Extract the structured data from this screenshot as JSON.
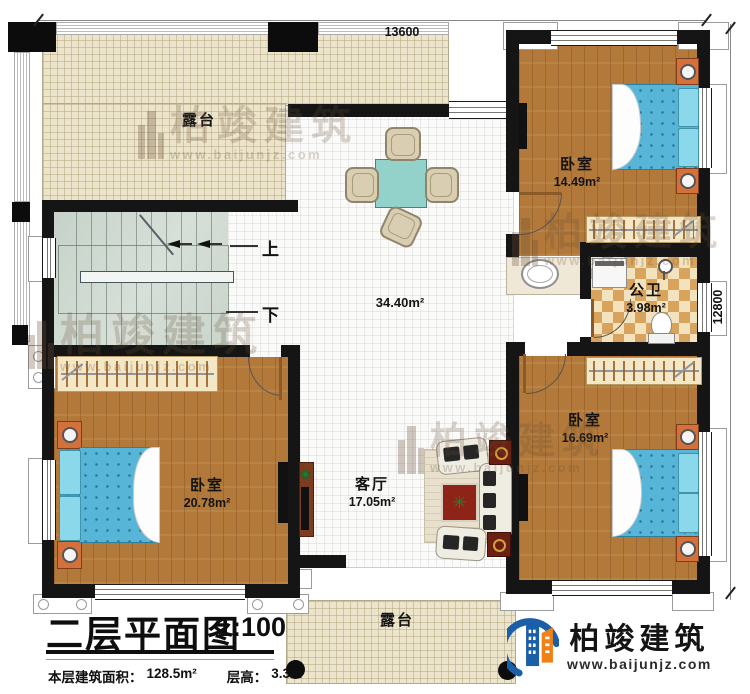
{
  "title_block": {
    "title": "二层平面图",
    "scale": "1:100",
    "area_label": "本层建筑面积：",
    "area_value": "128.5m²",
    "floor_height_label": "层高：",
    "floor_height_value": "3.3m"
  },
  "dimensions": {
    "width_mm": "13600",
    "height_mm": "12800"
  },
  "rooms": {
    "terrace_top": "露台",
    "terrace_bottom": "露台",
    "hall_area": "34.40m²",
    "bedroom_top_right": {
      "name": "卧室",
      "area": "14.49m²"
    },
    "bedroom_bottom_left": {
      "name": "卧室",
      "area": "20.78m²"
    },
    "bedroom_right": {
      "name": "卧室",
      "area": "16.69m²"
    },
    "bathroom": {
      "name": "公卫",
      "area": "3.98m²"
    },
    "living_room": {
      "name": "客厅",
      "area": "17.05m²"
    }
  },
  "stairs": {
    "up": "上",
    "down": "下"
  },
  "branding": {
    "company": "柏竣建筑",
    "website": "www.baijunjz.com"
  },
  "icons": {
    "plant": "✳"
  },
  "colors": {
    "wood": "#b2793a",
    "bed_blue": "#57b6d8",
    "terrace": "#ece4cb",
    "bath_tile": "#d8a35c",
    "logo_blue": "#1b5fa8",
    "logo_orange": "#f08119"
  }
}
